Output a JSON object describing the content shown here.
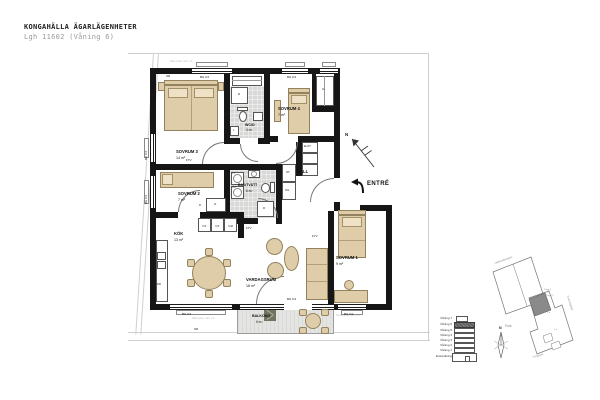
{
  "header": {
    "title": "KONGAHÄLLA ÄGARLÄGENHETER",
    "subtitle": "Lgh 11602 (Våning 6)"
  },
  "plan": {
    "north": "N",
    "entre": "ENTRÉ",
    "rooms": {
      "sovrum1": {
        "name": "SOVRUM 1",
        "area": "9 m²"
      },
      "sovrum2": {
        "name": "SOVRUM 2",
        "area": "7 m²"
      },
      "sovrum3": {
        "name": "SOVRUM 3",
        "area": "14 m²"
      },
      "sovrum4": {
        "name": "SOVRUM 4",
        "area": "7 m²"
      },
      "wcd": {
        "name": "WC/D",
        "area": "4 m²"
      },
      "badtvatt": {
        "name": "BAD/TVÄTT",
        "area": "6 m²"
      },
      "hall": {
        "name": "HALL"
      },
      "kok": {
        "name": "KÖK",
        "area": "13 m²"
      },
      "vardagsrum": {
        "name": "VARDAGSRUM",
        "area": "18 m²"
      },
      "balkong": {
        "name": "BALKONG",
        "area": "6 m²"
      }
    },
    "fixtures": {
      "bh": "BH 0.6",
      "sr": "SR",
      "g": "G",
      "sg": "SG",
      "st": "ST",
      "l": "L",
      "fl": "Fl",
      "kf": "K/F",
      "um": "U/M",
      "dm": "DM",
      "ftv": "FTV",
      "elft": "EL/FT",
      "d": "D",
      "tm": "TM",
      "tt": "TT"
    },
    "notes": {
      "top": "Tak ovan rum v.1",
      "bottom": "Tak ovan rum v.1",
      "right": "Grannens rum v.1"
    }
  },
  "locator": {
    "floors": [
      "Våning 7",
      "Våning 6",
      "Våning 5",
      "Våning 4",
      "Våning 3",
      "Våning 2",
      "Våning 1",
      "Entrévåning"
    ],
    "highlighted_floor": "Våning 6",
    "north": "N",
    "site": {
      "park": "Park",
      "street_top": "Uddevallavägen",
      "street_right": "Kvartettgatan",
      "street_bottom": "Triogatan",
      "note1": "Trapp 1",
      "note2": "Trapp 2",
      "note3": "1 tr",
      "note4": "2 tr"
    }
  },
  "colors": {
    "wall": "#161616",
    "furniture": "#dfcdaa",
    "furniture_border": "#94825c",
    "tile": "#d8d8d6",
    "balcony_floor": "#e4e4e2",
    "floor_highlight": "#787878",
    "site_unit": "#8a8a8a"
  }
}
